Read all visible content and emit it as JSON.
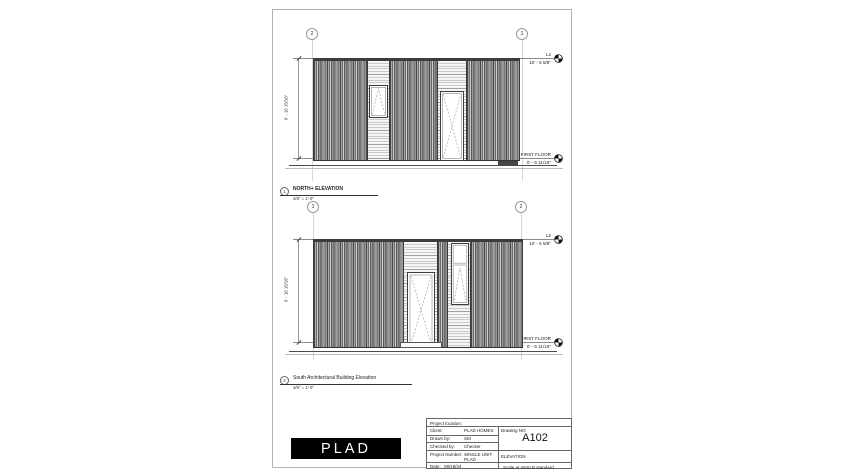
{
  "page": {
    "logo_text": "PLAD"
  },
  "elevations": [
    {
      "grid_left": "2",
      "grid_right": "1",
      "levels": {
        "top_name": "L2",
        "top_value": "10' - 5 5/8\"",
        "bottom_name": "FIRST FLOOR",
        "bottom_value": "0' - 6 11/16\""
      },
      "dimension": "9' - 10 15/16\"",
      "view_number": "1",
      "view_title": "NORTH+ ELEVATION",
      "view_scale": "3/8\" = 1'-0\""
    },
    {
      "grid_left": "1",
      "grid_right": "2",
      "levels": {
        "top_name": "L2",
        "top_value": "10' - 5 5/8\"",
        "bottom_name": "FIRST FLOOR",
        "bottom_value": "0' - 6 11/16\""
      },
      "dimension": "9' - 10 15/16\"",
      "view_number": "2",
      "view_title": "South Architectural Building Elevation",
      "view_scale": "3/8\" = 1'-0\""
    }
  ],
  "titleblock": {
    "project_location": "Project location:",
    "client_label": "Client:",
    "client": "PLAD HOMES",
    "drawn_by_label": "Drawn by:",
    "drawn_by": "SM",
    "checked_by_label": "Checked by:",
    "checked_by": "Checker",
    "project_number_label": "Project Number:",
    "project_number": "SINGLE UNIT PLAD",
    "date_label": "Date:",
    "date": "09/18/24",
    "drawing_no_label": "Drawing NO:",
    "drawing_no": "A102",
    "sheet_name": "ELEVATION",
    "scale_note": "Scale at ANSI B standard"
  }
}
